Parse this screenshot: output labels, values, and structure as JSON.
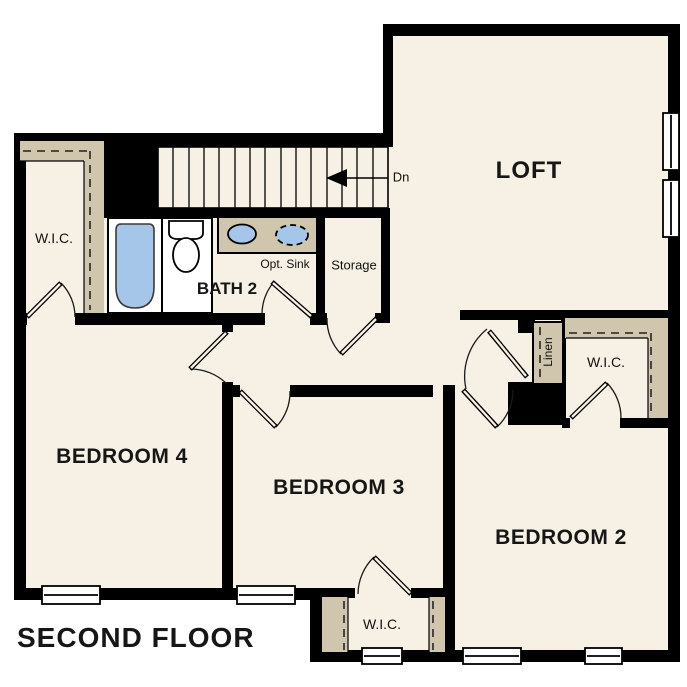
{
  "plan_title": "SECOND FLOOR",
  "rooms": {
    "loft": {
      "label": "LOFT"
    },
    "bedroom_2": {
      "label": "BEDROOM 2"
    },
    "bedroom_3": {
      "label": "BEDROOM 3"
    },
    "bedroom_4": {
      "label": "BEDROOM 4"
    },
    "bath_2": {
      "label": "BATH 2",
      "note": "Opt. Sink"
    },
    "storage": {
      "label": "Storage"
    },
    "linen": {
      "label": "Linen"
    },
    "wic_bedroom_4": {
      "label": "W.I.C."
    },
    "wic_bedroom_2": {
      "label": "W.I.C."
    },
    "wic_bedroom_3": {
      "label": "W.I.C."
    }
  },
  "stairs": {
    "direction_label": "Dn"
  },
  "colors": {
    "floor": "#f7f0e4",
    "shelf": "#d0c5ad",
    "fixture_blue": "#a5c6e8",
    "wall": "#000000",
    "background": "#ffffff"
  }
}
